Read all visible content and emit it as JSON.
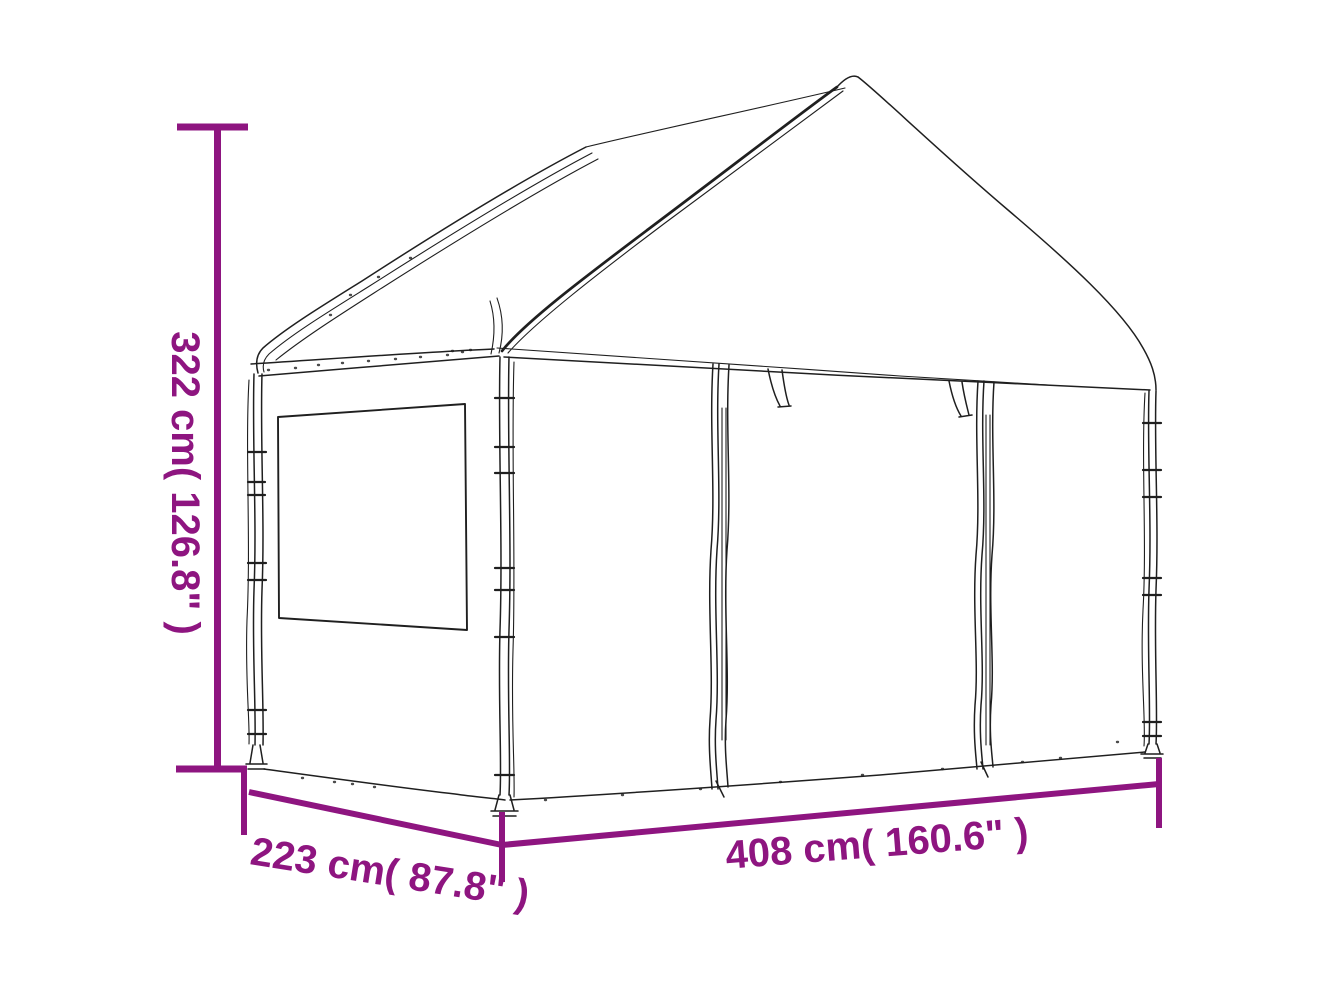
{
  "colors": {
    "accent": "#8e1580",
    "line": "#1f1f1f",
    "background": "#ffffff"
  },
  "illustration": {
    "subject": "Line drawing of a white gazebo with peaked roof, left side wall with window, and front wall with two zippered panels and hanging tie straps"
  },
  "dimensions": {
    "height": {
      "label": "322 cm( 126.8\" )",
      "cm": 322,
      "inches": 126.8,
      "axis": "vertical-left"
    },
    "depth": {
      "label": "223 cm( 87.8\" )",
      "cm": 223,
      "inches": 87.8,
      "axis": "diagonal-bottom-left"
    },
    "width": {
      "label": "408 cm( 160.6\" )",
      "cm": 408,
      "inches": 160.6,
      "axis": "horizontal-bottom-right"
    }
  }
}
